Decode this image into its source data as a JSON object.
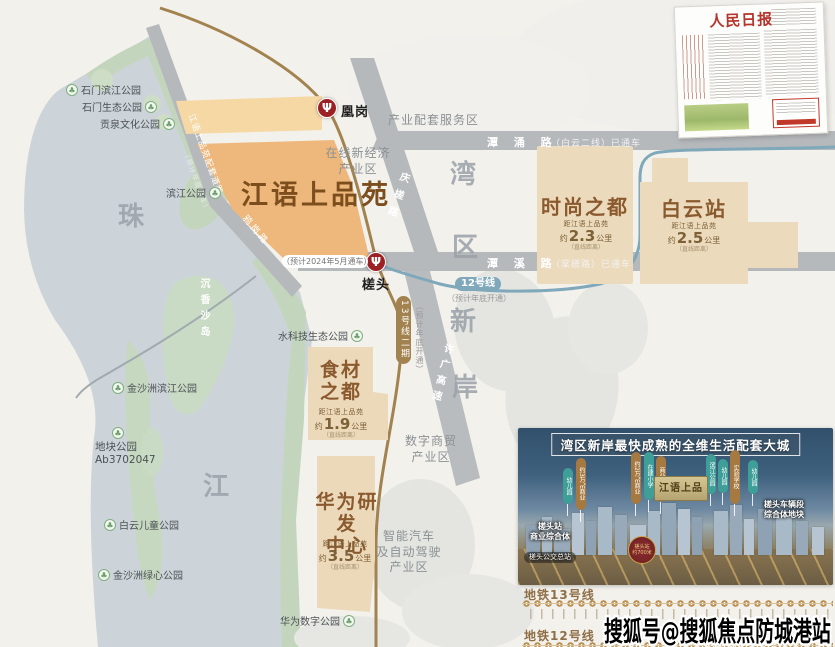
{
  "watermark": "搜狐号@搜狐焦点防城港站",
  "newspaper": {
    "masthead": "人民日报"
  },
  "map": {
    "project_title": "江语上品苑",
    "big_letters": {
      "zhu": "珠",
      "jiang": "江",
      "wan": "湾",
      "qu": "区",
      "xin": "新",
      "an": "岸"
    },
    "island": "沉香沙岛",
    "stations": {
      "huanggang": "凰岗",
      "chatou": "槎头",
      "chatou_note": "（预计2024年5月通车）"
    },
    "roads": {
      "tanyong": "潭 涌 路",
      "tanyong_note": "（白云二线）已通车",
      "tanxi": "潭 溪 路",
      "tanxi_note": "（棠槎路）已通车",
      "qingcha": "庆槎路",
      "xuguang": "许广高速",
      "peitao": "江语上品苑配套道路",
      "peitao_note": "（预计年底通车）",
      "yagang": "鸦岗路"
    },
    "metro": {
      "line13": "13号线二期",
      "line13_note": "（预计年底开通）",
      "line12": "12号线",
      "line12_note": "（预计年底开通）"
    },
    "areas": {
      "service": "产业配套服务区",
      "online": "在线新经济\n产业区",
      "digital": "数字商贸\n产业区",
      "smartcar": "智能汽车\n及自动驾驶\n产业区"
    },
    "dist": {
      "label": "距江语上品苑",
      "prefix": "约",
      "unit": "公里",
      "note": "（直线距离）"
    },
    "blocks": [
      {
        "name": "时尚之都",
        "value": "2.3"
      },
      {
        "name": "白云站",
        "value": "2.5"
      },
      {
        "name": "食材\n之都",
        "value": "1.9"
      },
      {
        "name": "华为研发\n中心",
        "value": "3.5"
      }
    ],
    "parks": [
      {
        "name": "石门滨江公园"
      },
      {
        "name": "石门生态公园"
      },
      {
        "name": "贡泉文化公园"
      },
      {
        "name": "滨江公园"
      },
      {
        "name": "水科技生态公园"
      },
      {
        "name": "金沙洲滨江公园"
      },
      {
        "name": "地块公园\nAb3702047"
      },
      {
        "name": "白云儿童公园"
      },
      {
        "name": "金沙洲绿心公园"
      },
      {
        "name": "华为数字公园"
      }
    ]
  },
  "promo": {
    "title": "湾区新岸最快成熟的全维生活配套大城",
    "plaque": "江语上品",
    "badge": "槎头站\n约700米",
    "tags": [
      {
        "label": "幼儿园"
      },
      {
        "label": "约3万㎡商业"
      },
      {
        "label": "约2万㎡商业"
      },
      {
        "label": "在建小学"
      },
      {
        "label": "商业中心"
      },
      {
        "label": "滨江公园"
      },
      {
        "label": "幼儿园"
      },
      {
        "label": "实验学校"
      },
      {
        "label": "幼儿园"
      }
    ],
    "landmarks": [
      {
        "label": "槎头站\n商业综合体"
      },
      {
        "label": "槎头公交总站"
      },
      {
        "label": "槎头车辆段\n综合体地块"
      }
    ]
  },
  "legend": [
    {
      "label": "地铁13号线"
    },
    {
      "label": "地铁12号线"
    }
  ]
}
